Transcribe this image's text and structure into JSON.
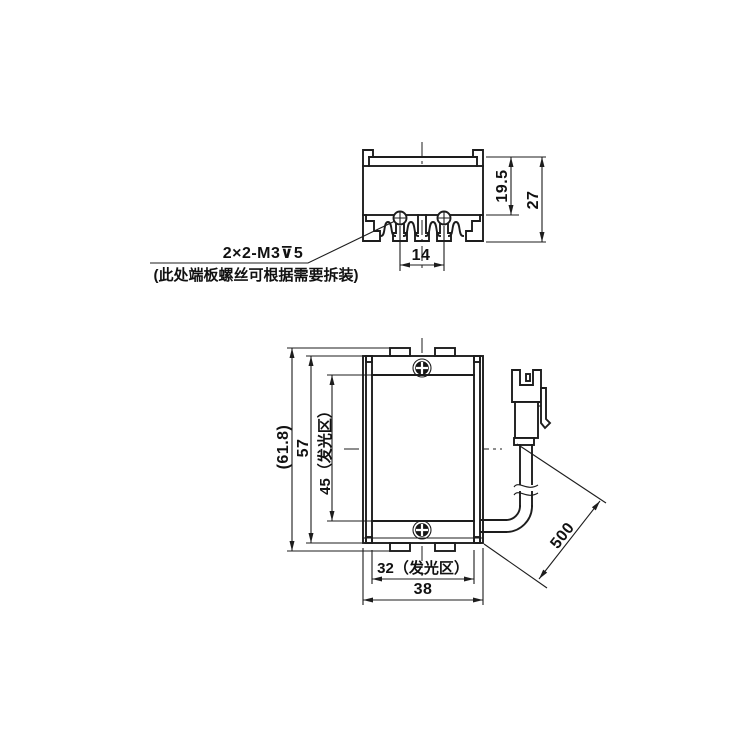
{
  "meta": {
    "kind": "mechanical engineering drawing",
    "background": "#ffffff",
    "line_color": "#1d1d1d"
  },
  "views": {
    "side_profile": {
      "dims": {
        "inner_height": "19.5",
        "overall_height": "27",
        "screw_spacing": "14"
      },
      "note": {
        "line1": "2×2-M3⊽5",
        "line2": "(此处端板螺丝可根据需要拆装)"
      }
    },
    "front": {
      "dims": {
        "overall_height_ref": "(61.8)",
        "body_height": "57",
        "emitting_height": "45（发光区）",
        "emitting_width": "32（发光区）",
        "body_width": "38",
        "cable_length": "500"
      }
    }
  }
}
